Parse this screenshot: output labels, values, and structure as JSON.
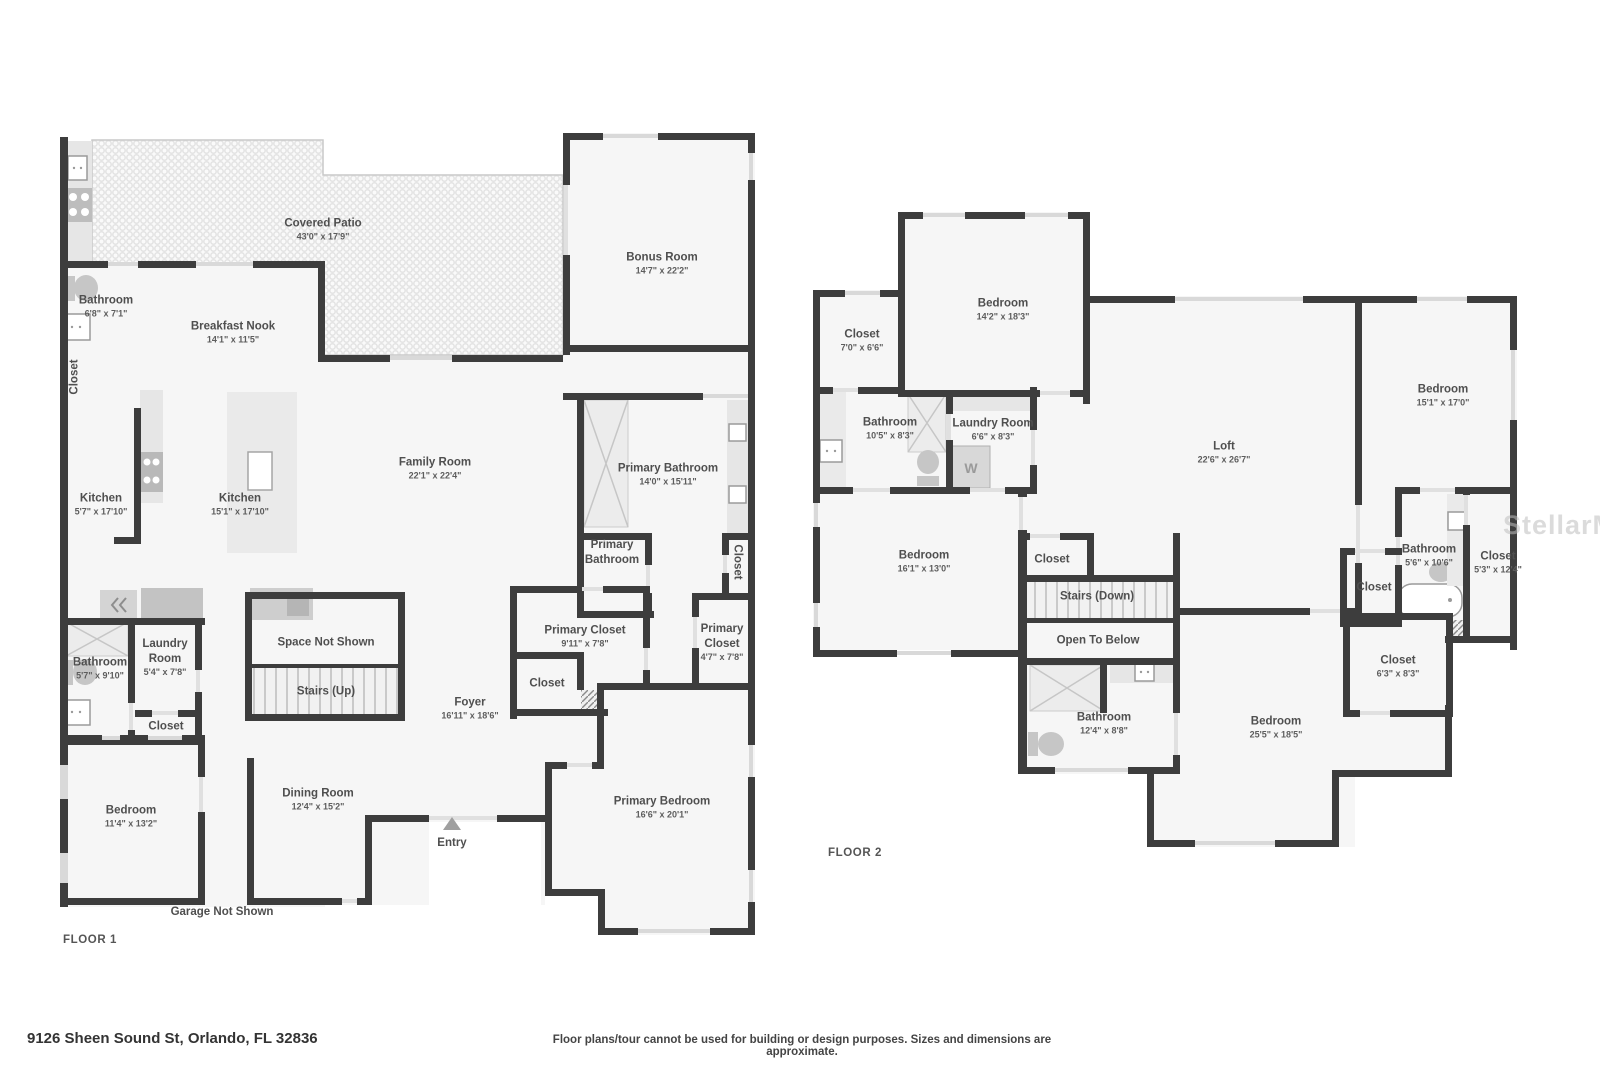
{
  "watermark": "StellarMLS",
  "footer": {
    "address": "9126 Sheen Sound St, Orlando, FL 32836",
    "disclaimer": "Floor plans/tour cannot be used for building or design purposes. Sizes and dimensions are approximate."
  },
  "floor1": {
    "floor_label": "FLOOR 1",
    "garage_note": "Garage Not Shown",
    "entry_label": "Entry",
    "rooms": {
      "covered_patio": {
        "name": "Covered Patio",
        "dims": "43'0\" x 17'9\""
      },
      "bathroom": {
        "name": "Bathroom",
        "dims": "6'8\" x 7'1\""
      },
      "closet_wall": {
        "name": "Closet"
      },
      "breakfast_nook": {
        "name": "Breakfast Nook",
        "dims": "14'1\" x 11'5\""
      },
      "bonus_room": {
        "name": "Bonus Room",
        "dims": "14'7\" x 22'2\""
      },
      "kitchen": {
        "name": "Kitchen",
        "dims": "5'7\" x 17'10\""
      },
      "kitchen_island": {
        "name": "Kitchen",
        "dims": "15'1\" x 17'10\""
      },
      "family_room": {
        "name": "Family Room",
        "dims": "22'1\" x 22'4\""
      },
      "primary_bathroom": {
        "name": "Primary Bathroom",
        "dims": "14'0\" x 15'11\""
      },
      "primary_water_closet": {
        "name": "Primary Bathroom"
      },
      "closet_primary_hall": {
        "name": "Closet"
      },
      "bathroom2": {
        "name": "Bathroom",
        "dims": "5'7\" x 9'10\""
      },
      "laundry_room": {
        "name": "Laundry Room",
        "dims": "5'4\" x 7'8\""
      },
      "closet_laundry": {
        "name": "Closet"
      },
      "space_not_shown": {
        "name": "Space Not Shown"
      },
      "stairs_up": {
        "name": "Stairs (Up)"
      },
      "primary_closet": {
        "name": "Primary Closet",
        "dims": "9'11\" x 7'8\""
      },
      "closet_foyer": {
        "name": "Closet"
      },
      "primary_closet2": {
        "name": "Primary Closet",
        "dims": "4'7\" x 7'8\""
      },
      "foyer": {
        "name": "Foyer",
        "dims": "16'11\" x 18'6\""
      },
      "bedroom": {
        "name": "Bedroom",
        "dims": "11'4\" x 13'2\""
      },
      "dining_room": {
        "name": "Dining Room",
        "dims": "12'4\" x 15'2\""
      },
      "primary_bedroom": {
        "name": "Primary Bedroom",
        "dims": "16'6\" x 20'1\""
      }
    }
  },
  "floor2": {
    "floor_label": "FLOOR 2",
    "rooms": {
      "bedroom1": {
        "name": "Bedroom",
        "dims": "14'2\" x 18'3\""
      },
      "closet1": {
        "name": "Closet",
        "dims": "7'0\" x 6'6\""
      },
      "bathroom1": {
        "name": "Bathroom",
        "dims": "10'5\" x 8'3\""
      },
      "laundry": {
        "name": "Laundry Room",
        "dims": "6'6\" x 8'3\"",
        "washer_label": "W"
      },
      "loft": {
        "name": "Loft",
        "dims": "22'6\" x 26'7\""
      },
      "bedroom2": {
        "name": "Bedroom",
        "dims": "15'1\" x 17'0\""
      },
      "bedroom3": {
        "name": "Bedroom",
        "dims": "16'1\" x 13'0\""
      },
      "closet2": {
        "name": "Closet"
      },
      "stairs_down": {
        "name": "Stairs (Down)"
      },
      "open_to_below": {
        "name": "Open To Below"
      },
      "bathroom2": {
        "name": "Bathroom",
        "dims": "5'6\" x 10'6\""
      },
      "closet3": {
        "name": "Closet",
        "dims": "5'3\" x 12'4\""
      },
      "closet4": {
        "name": "Closet"
      },
      "closet5": {
        "name": "Closet",
        "dims": "6'3\" x 8'3\""
      },
      "bathroom3": {
        "name": "Bathroom",
        "dims": "12'4\" x 8'8\""
      },
      "bedroom4": {
        "name": "Bedroom",
        "dims": "25'5\" x 18'5\""
      }
    }
  }
}
